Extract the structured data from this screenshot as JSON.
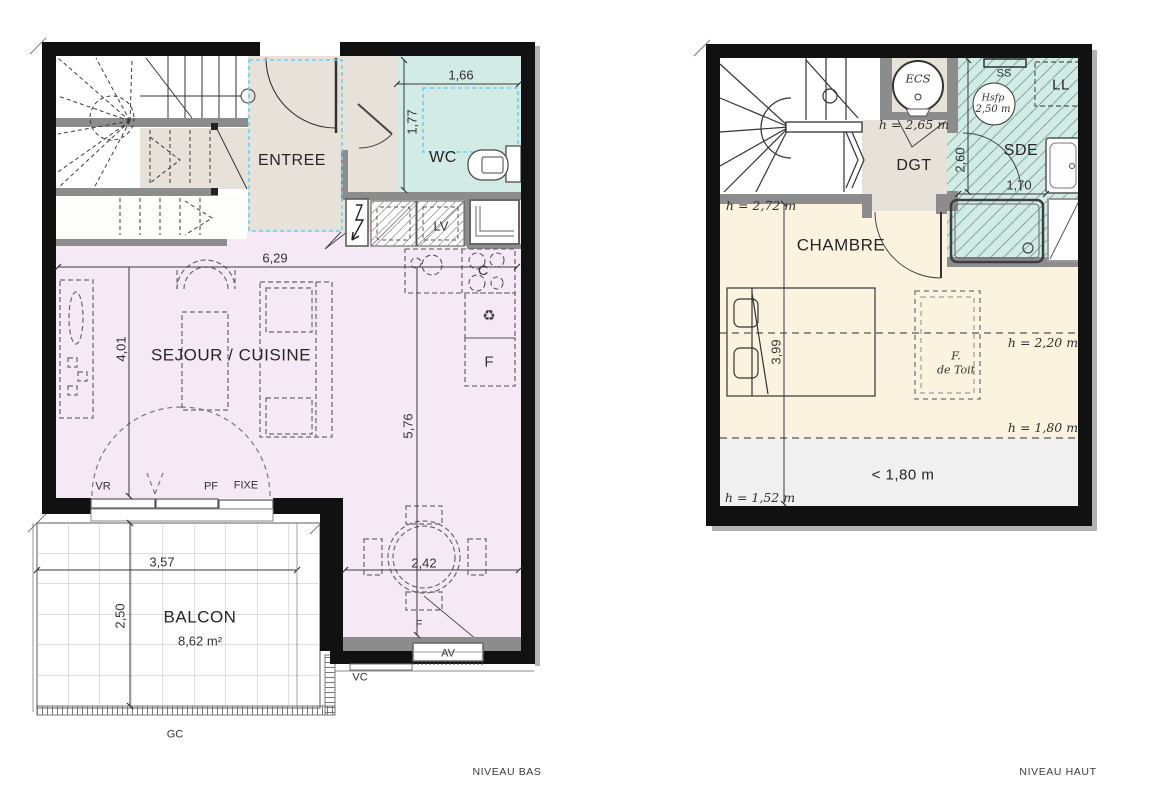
{
  "captions": {
    "bas": "NIVEAU BAS",
    "haut": "NIVEAU HAUT"
  },
  "niveau_bas": {
    "rooms": {
      "entree": "ENTREE",
      "wc": "WC",
      "sejour_cuisine": "SEJOUR / CUISINE",
      "balcon": "BALCON",
      "balcon_area": "8,62 m²"
    },
    "dims": {
      "wc_width": "1,66",
      "wc_depth": "1,77",
      "sejour_width": "6,29",
      "sejour_depth": "4,01",
      "sejour_right": "5,76",
      "balcon_width": "3,57",
      "balcon_depth": "2,50",
      "dining_width": "2,42"
    },
    "marks": {
      "vr": "VR",
      "pf": "PF",
      "fixe": "FIXE",
      "lv": "LV",
      "cooktop": "C",
      "fridge": "F",
      "recycle": "♻",
      "window_f": "F",
      "av": "AV",
      "vc": "VC",
      "gc": "GC"
    }
  },
  "niveau_haut": {
    "rooms": {
      "chambre": "CHAMBRE",
      "dgt": "DGT",
      "sde": "SDE",
      "ll": "LL",
      "ss": "SS",
      "ecs": "ECS",
      "hsfp_line1": "Hsfp",
      "hsfp_line2": "2,50 m",
      "roof_window_line1": "F.",
      "roof_window_line2": "de Toit",
      "low_zone": "< 1,80 m"
    },
    "dims": {
      "chambre_depth": "3,99",
      "sde_height": "2,60",
      "sde_width": "1,70"
    },
    "heights": {
      "ecs": "h = 2,65 m",
      "chambre": "h = 2,72 m",
      "mid": "h = 2,20 m",
      "low": "h = 1,80 m",
      "lowest": "h = 1,52 m"
    }
  },
  "colors": {
    "lavender": "#f5e9f5",
    "teal": "#d3ebe5",
    "beige": "#e6e1d9",
    "cream": "#fbf3e0",
    "grey_zone": "#f0f0f0",
    "wall_black": "#111111",
    "wall_grey": "#8c8c8c",
    "blue_dash": "#6fcdf5"
  }
}
